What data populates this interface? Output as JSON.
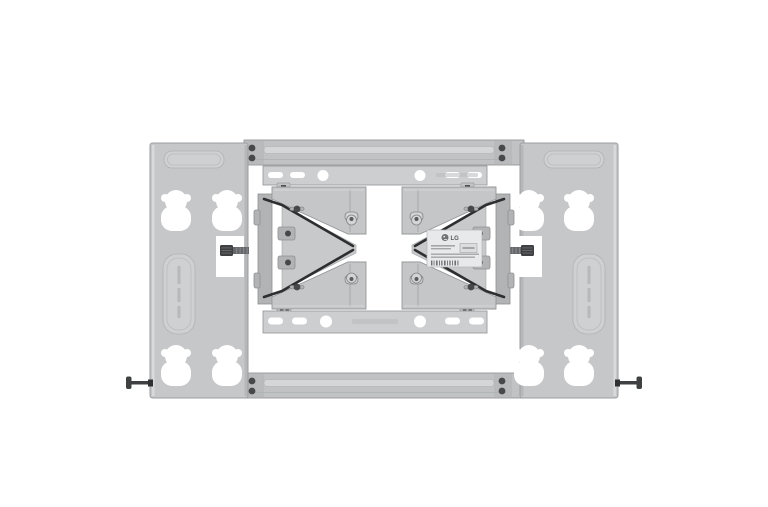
{
  "palette": {
    "background": "#ffffff",
    "cutout": "#ffffff",
    "plate": "#c6c7c9",
    "plate_edge": "#9b9da0",
    "plate_emboss": "#cfd0d2",
    "bar": "#c0c2c4",
    "bar_stripe": "#d5d6d8",
    "rail": "#cdcecf",
    "rail_edge": "#9a9c9e",
    "arm": "#c5c6c8",
    "arm_dark": "#b2b3b5",
    "wedge": "#c8c9cb",
    "cable": "#2d2e30",
    "hardware": "#47484a",
    "pin": "#d3d4d6",
    "label_bg": "#e8e9ea",
    "label_text": "#58595b",
    "label_line": "#a4a5a7"
  },
  "product_photo": {
    "alt": "Product photo of an LG slim TV wall mount: two silver wall plates with keyhole cutouts, a central frame with top and bottom TV rails, two folded articulating arms with black cables, an LG label in the center, and bolts protruding at the lower corners, on a white background",
    "brand_label": {
      "logo_text": "LG"
    }
  }
}
